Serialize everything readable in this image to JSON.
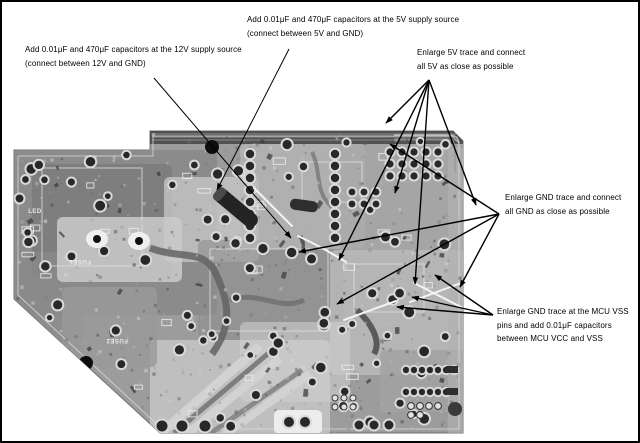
{
  "figure": {
    "type": "annotated PCB photograph",
    "background": "#ffffff",
    "border_color": "#000000"
  },
  "annotations": {
    "cap_12v": {
      "lines": [
        "Add 0.01μF and 470μF capacitors at the 12V supply source",
        "(connect between 12V and GND)"
      ]
    },
    "cap_5v": {
      "lines": [
        "Add 0.01μF and 470μF capacitors at the 5V supply source",
        "(connect between 5V and GND)"
      ]
    },
    "enlarge_5v": {
      "lines": [
        "Enlarge 5V trace and connect",
        "all 5V as close as possible"
      ]
    },
    "enlarge_gnd": {
      "lines": [
        "Enlarge GND trace and connect",
        "all GND as close as possible"
      ]
    },
    "mcu_vss": {
      "lines": [
        "Enlarge GND trace at the MCU VSS",
        "pins and add 0.01μF capacitors",
        "between MCU VCC and VSS"
      ]
    }
  },
  "board": {
    "silkscreen_labels": [
      "FUSE1",
      "FUSE2",
      "LED"
    ],
    "colors": {
      "base": "#9c9c9c",
      "dark_trace": "#4d4d4d",
      "pad_ring": "#d9d9d9",
      "pad_hole": "#282828",
      "annotation": "#000000"
    }
  }
}
